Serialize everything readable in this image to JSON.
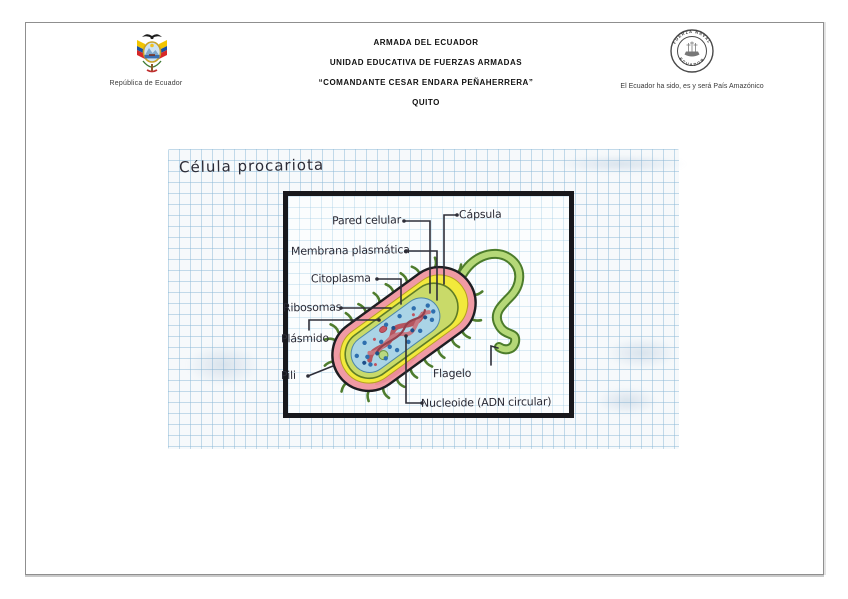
{
  "header": {
    "left": {
      "caption": "República de Ecuador"
    },
    "center": {
      "lines": [
        "ARMADA DEL ECUADOR",
        "UNIDAD EDUCATIVA DE FUERZAS ARMADAS",
        "“COMANDANTE CESAR ENDARA PEÑAHERRERA”",
        "QUITO"
      ]
    },
    "right": {
      "caption": "El Ecuador ha sido, es y será País Amazónico",
      "seal": {
        "top_text": "FUERZA NAVAL",
        "bottom_text": "ECUADOR"
      }
    }
  },
  "worksheet": {
    "title": "Célula procariota",
    "diagram": {
      "subject": "prokaryotic cell hand drawing",
      "labels": [
        {
          "id": "pared-celular",
          "text": "Pared celular"
        },
        {
          "id": "capsula",
          "text": "Cápsula"
        },
        {
          "id": "membrana-plasmatica",
          "text": "Membrana plasmática"
        },
        {
          "id": "citoplasma",
          "text": "Citoplasma"
        },
        {
          "id": "ribosomas",
          "text": "Ribosomas"
        },
        {
          "id": "plasmido",
          "text": "Plásmido"
        },
        {
          "id": "pili",
          "text": "Pili"
        },
        {
          "id": "flagelo",
          "text": "Flagelo"
        },
        {
          "id": "nucleoide",
          "text": "Nucleoide (ADN circular)"
        }
      ]
    }
  },
  "colors": {
    "capsule_pink": "#f09aa4",
    "cell_wall_yellow": "#f2e93c",
    "membrane_green": "#c9da69",
    "cytoplasm_blue": "#aad4e6",
    "nucleoid_red": "#b5555f",
    "flagellum_green": "#b5d878",
    "grid_blue": "#c3dcea",
    "ink": "#2b2b36"
  }
}
